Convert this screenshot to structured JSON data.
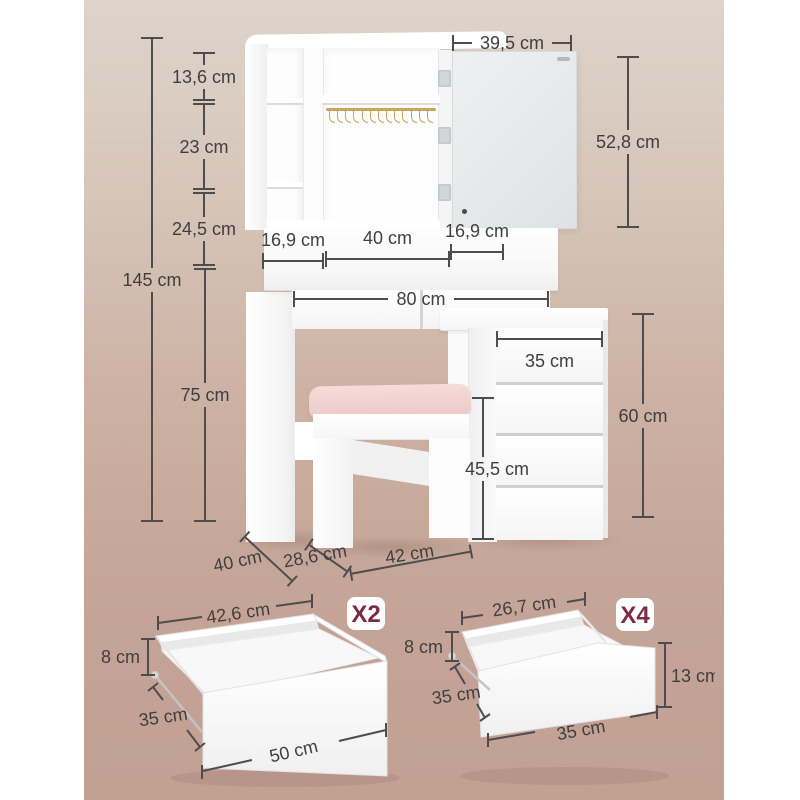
{
  "diagram": {
    "unit": "cm",
    "vanity": {
      "total_height": "145 cm",
      "upper_shelf_height": "13,6 cm",
      "middle_shelf_height": "23 cm",
      "lower_shelf_height": "24,5 cm",
      "table_height": "75 cm",
      "mirror_door_width": "39,5 cm",
      "mirror_door_height": "52,8 cm",
      "left_cubby_width": "16,9 cm",
      "center_cubby_width": "40 cm",
      "right_cubby_width": "16,9 cm",
      "tabletop_width": "80 cm",
      "drawer_cabinet_width": "35 cm",
      "drawer_cabinet_height": "60 cm",
      "stool_seat_height": "45,5 cm",
      "table_depth": "40 cm",
      "stool_depth": "28,6 cm",
      "stool_width": "42 cm"
    },
    "wide_drawer": {
      "count_label": "X2",
      "top_inner_width": "42,6 cm",
      "side_height": "8 cm",
      "depth": "35 cm",
      "front_width": "50 cm"
    },
    "small_drawer": {
      "count_label": "X4",
      "top_inner_width": "26,7 cm",
      "side_height": "8 cm",
      "depth": "35 cm",
      "front_width": "35 cm",
      "front_height": "13 cm"
    },
    "colors": {
      "quantity_badge_text": "#7b2c43",
      "gold_rail": "#c9a45c",
      "stool_cushion": "#efcfcc",
      "background_top": "#ded4ca",
      "background_bottom": "#c2a193",
      "dimension_lines": "#4d4d4d"
    }
  }
}
